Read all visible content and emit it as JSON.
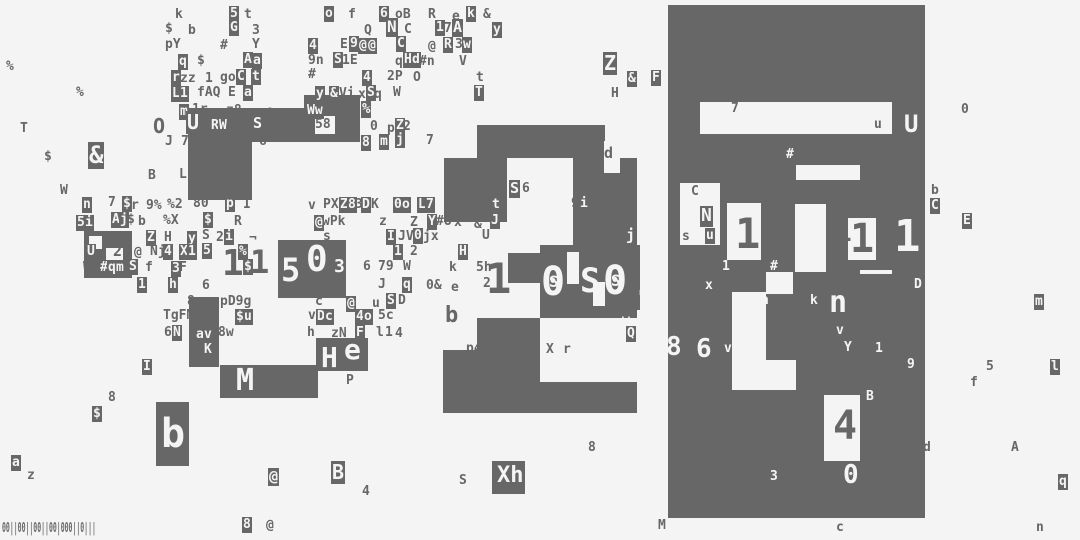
{
  "canvas": {
    "width": 1080,
    "height": 540,
    "bg": "#f4f4f4",
    "ink": "#676767"
  },
  "barcode": {
    "text": "00||00||00||00|000||0|||"
  },
  "blocks": [
    [
      668,
      5,
      257,
      513
    ],
    [
      188,
      108,
      172,
      34
    ],
    [
      304,
      95,
      56,
      14
    ],
    [
      188,
      142,
      64,
      58
    ],
    [
      84,
      231,
      48,
      47
    ],
    [
      278,
      240,
      68,
      58
    ],
    [
      189,
      297,
      30,
      70
    ],
    [
      220,
      365,
      98,
      33
    ],
    [
      316,
      338,
      52,
      33
    ],
    [
      156,
      402,
      33,
      64
    ],
    [
      492,
      461,
      33,
      33
    ],
    [
      477,
      125,
      128,
      33
    ],
    [
      444,
      158,
      63,
      64
    ],
    [
      573,
      158,
      64,
      95
    ],
    [
      508,
      253,
      32,
      30
    ],
    [
      540,
      245,
      100,
      65
    ],
    [
      477,
      318,
      63,
      64
    ],
    [
      540,
      295,
      97,
      23
    ],
    [
      443,
      350,
      64,
      32
    ],
    [
      443,
      382,
      194,
      31
    ]
  ],
  "holes": [
    [
      700,
      102,
      192,
      32
    ],
    [
      796,
      165,
      64,
      15
    ],
    [
      680,
      183,
      40,
      62
    ],
    [
      727,
      203,
      34,
      57
    ],
    [
      795,
      204,
      31,
      68
    ],
    [
      848,
      218,
      28,
      42
    ],
    [
      732,
      292,
      34,
      78
    ],
    [
      766,
      272,
      27,
      22
    ],
    [
      860,
      270,
      32,
      4
    ],
    [
      732,
      360,
      64,
      30
    ],
    [
      824,
      395,
      36,
      66
    ],
    [
      604,
      141,
      16,
      32
    ],
    [
      567,
      252,
      12,
      32
    ],
    [
      593,
      282,
      12,
      24
    ],
    [
      315,
      116,
      20,
      18
    ],
    [
      89,
      236,
      13,
      13
    ],
    [
      106,
      248,
      17,
      13
    ]
  ],
  "glyphs": [
    [
      175,
      8,
      "k",
      0
    ],
    [
      229,
      6,
      "5",
      1
    ],
    [
      244,
      8,
      "t",
      0
    ],
    [
      324,
      6,
      "o",
      1
    ],
    [
      348,
      8,
      "f",
      0
    ],
    [
      379,
      6,
      "6",
      1
    ],
    [
      395,
      8,
      "oB",
      0
    ],
    [
      428,
      8,
      "R",
      0
    ],
    [
      452,
      10,
      "e",
      0
    ],
    [
      466,
      6,
      "k",
      1
    ],
    [
      483,
      8,
      "&",
      0
    ],
    [
      165,
      22,
      "$",
      0
    ],
    [
      188,
      24,
      "b",
      0
    ],
    [
      229,
      20,
      "G",
      1
    ],
    [
      252,
      24,
      "3",
      0
    ],
    [
      364,
      24,
      "Q",
      0
    ],
    [
      386,
      18,
      "N",
      1,
      16
    ],
    [
      404,
      23,
      "C",
      0
    ],
    [
      435,
      20,
      "1",
      1
    ],
    [
      444,
      22,
      "7",
      0
    ],
    [
      452,
      19,
      "A",
      1,
      15
    ],
    [
      492,
      22,
      "y",
      1
    ],
    [
      165,
      38,
      "pY",
      0
    ],
    [
      220,
      39,
      "#",
      0
    ],
    [
      252,
      38,
      "Y",
      0
    ],
    [
      308,
      38,
      "4",
      1
    ],
    [
      340,
      38,
      "E",
      0
    ],
    [
      349,
      36,
      "9",
      1
    ],
    [
      358,
      38,
      "@",
      1
    ],
    [
      367,
      38,
      "@",
      1
    ],
    [
      396,
      36,
      "C",
      1
    ],
    [
      428,
      40,
      "@",
      0
    ],
    [
      443,
      37,
      "R",
      1
    ],
    [
      455,
      38,
      "3",
      0
    ],
    [
      462,
      37,
      "w",
      1
    ],
    [
      178,
      54,
      "q",
      1
    ],
    [
      197,
      54,
      "$",
      0
    ],
    [
      243,
      52,
      "A",
      1
    ],
    [
      252,
      53,
      "a",
      1
    ],
    [
      308,
      54,
      "9n",
      0
    ],
    [
      333,
      52,
      "S",
      1
    ],
    [
      342,
      54,
      "1E",
      0
    ],
    [
      395,
      55,
      "q",
      0
    ],
    [
      403,
      52,
      "H",
      1
    ],
    [
      411,
      52,
      "d",
      1
    ],
    [
      419,
      55,
      "#n",
      0
    ],
    [
      459,
      55,
      "V",
      0
    ],
    [
      603,
      52,
      "Z",
      1,
      20
    ],
    [
      171,
      70,
      "r",
      1
    ],
    [
      180,
      72,
      "zz",
      0
    ],
    [
      205,
      72,
      "1",
      0
    ],
    [
      220,
      71,
      "go",
      0
    ],
    [
      236,
      69,
      "C",
      1
    ],
    [
      251,
      69,
      "t",
      1
    ],
    [
      308,
      68,
      "#",
      0
    ],
    [
      362,
      70,
      "4",
      1
    ],
    [
      387,
      70,
      "2P",
      0
    ],
    [
      413,
      71,
      "O",
      0
    ],
    [
      476,
      71,
      "t",
      0
    ],
    [
      627,
      71,
      "&",
      1
    ],
    [
      651,
      70,
      "F",
      1
    ],
    [
      171,
      86,
      "L",
      1
    ],
    [
      179,
      86,
      "1",
      1
    ],
    [
      197,
      86,
      "fAQ",
      0
    ],
    [
      228,
      86,
      "E",
      0
    ],
    [
      243,
      85,
      "a",
      1
    ],
    [
      315,
      86,
      "y",
      1
    ],
    [
      329,
      86,
      "&",
      1
    ],
    [
      339,
      87,
      "Vi",
      0
    ],
    [
      358,
      88,
      "x",
      0
    ],
    [
      366,
      85,
      "S",
      1
    ],
    [
      374,
      88,
      "q",
      0
    ],
    [
      393,
      86,
      "W",
      0
    ],
    [
      474,
      85,
      "T",
      1
    ],
    [
      611,
      87,
      "H",
      0
    ],
    [
      6,
      60,
      "%",
      0
    ],
    [
      76,
      86,
      "%",
      0
    ],
    [
      20,
      122,
      "T",
      0
    ],
    [
      44,
      150,
      "$",
      0
    ],
    [
      88,
      142,
      "&",
      1,
      24
    ],
    [
      60,
      184,
      "W",
      0
    ],
    [
      179,
      104,
      "m",
      1
    ],
    [
      192,
      103,
      "1r",
      0
    ],
    [
      226,
      104,
      "z8",
      0
    ],
    [
      266,
      105,
      "e",
      0
    ],
    [
      306,
      103,
      "Ww",
      1
    ],
    [
      338,
      105,
      "8",
      0
    ],
    [
      361,
      101,
      "%",
      1,
      14
    ],
    [
      961,
      103,
      "0",
      0
    ],
    [
      153,
      116,
      "O",
      0,
      20
    ],
    [
      186,
      111,
      "U",
      1,
      20
    ],
    [
      210,
      118,
      "R",
      1
    ],
    [
      218,
      118,
      "W",
      1
    ],
    [
      243,
      120,
      "6",
      0
    ],
    [
      252,
      115,
      "S",
      1,
      15
    ],
    [
      315,
      118,
      "58",
      0
    ],
    [
      370,
      120,
      "0",
      0
    ],
    [
      387,
      122,
      "p",
      0
    ],
    [
      395,
      118,
      "Z",
      1
    ],
    [
      403,
      120,
      "2",
      0
    ],
    [
      165,
      135,
      "J",
      0
    ],
    [
      181,
      135,
      "7x",
      0
    ],
    [
      217,
      134,
      "7d",
      0
    ],
    [
      259,
      135,
      "6",
      0
    ],
    [
      361,
      135,
      "8",
      1
    ],
    [
      379,
      134,
      "m",
      1
    ],
    [
      395,
      132,
      "j",
      1
    ],
    [
      426,
      134,
      "7",
      0
    ],
    [
      604,
      146,
      "d",
      0,
      15
    ],
    [
      731,
      102,
      "7",
      0
    ],
    [
      874,
      118,
      "u",
      0
    ],
    [
      904,
      112,
      "U",
      2,
      24
    ],
    [
      786,
      148,
      "#",
      2
    ],
    [
      219,
      144,
      "t",
      0,
      22
    ],
    [
      148,
      169,
      "B",
      0
    ],
    [
      179,
      168,
      "L",
      0
    ],
    [
      82,
      197,
      "n",
      1
    ],
    [
      108,
      196,
      "7",
      0
    ],
    [
      122,
      196,
      "$",
      1
    ],
    [
      131,
      199,
      "r",
      0
    ],
    [
      146,
      199,
      "9%",
      0
    ],
    [
      167,
      198,
      "%2",
      0
    ],
    [
      193,
      197,
      "80",
      0
    ],
    [
      225,
      196,
      "p",
      1
    ],
    [
      243,
      198,
      "I",
      0
    ],
    [
      308,
      199,
      "v",
      0
    ],
    [
      323,
      198,
      "PX",
      0
    ],
    [
      339,
      197,
      "Z",
      1
    ],
    [
      347,
      197,
      "8",
      1
    ],
    [
      355,
      198,
      "3",
      0
    ],
    [
      361,
      197,
      "D",
      1
    ],
    [
      371,
      198,
      "K",
      0
    ],
    [
      393,
      197,
      "0",
      1
    ],
    [
      401,
      197,
      "o",
      1
    ],
    [
      417,
      197,
      "L",
      1
    ],
    [
      425,
      197,
      "7",
      1
    ],
    [
      443,
      199,
      "I",
      0
    ],
    [
      458,
      200,
      "z",
      0
    ],
    [
      691,
      185,
      "C",
      0
    ],
    [
      931,
      184,
      "b",
      0
    ],
    [
      76,
      215,
      "5",
      1
    ],
    [
      84,
      215,
      "i",
      1
    ],
    [
      111,
      212,
      "A",
      1
    ],
    [
      119,
      212,
      "j",
      1
    ],
    [
      127,
      213,
      "$",
      0
    ],
    [
      138,
      215,
      "b",
      0
    ],
    [
      163,
      214,
      "%X",
      0
    ],
    [
      203,
      212,
      "$",
      1
    ],
    [
      234,
      215,
      "R",
      0
    ],
    [
      314,
      215,
      "@",
      1
    ],
    [
      322,
      215,
      "wPk",
      0
    ],
    [
      379,
      215,
      "z",
      0
    ],
    [
      410,
      216,
      "Z",
      0
    ],
    [
      427,
      214,
      "Y",
      1
    ],
    [
      436,
      215,
      "#U",
      0
    ],
    [
      454,
      216,
      "x",
      0
    ],
    [
      474,
      218,
      "&",
      0
    ],
    [
      490,
      213,
      "J",
      1
    ],
    [
      930,
      198,
      "C",
      1
    ],
    [
      682,
      230,
      "s",
      0
    ],
    [
      962,
      213,
      "E",
      1
    ],
    [
      146,
      230,
      "Z",
      1
    ],
    [
      164,
      231,
      "H",
      0
    ],
    [
      187,
      231,
      "y",
      1
    ],
    [
      202,
      229,
      "S",
      0
    ],
    [
      216,
      231,
      "2",
      0
    ],
    [
      224,
      229,
      "i",
      1
    ],
    [
      249,
      232,
      "¬",
      0
    ],
    [
      323,
      230,
      "s",
      0
    ],
    [
      386,
      229,
      "I",
      1
    ],
    [
      398,
      230,
      "JV",
      0
    ],
    [
      413,
      228,
      "0",
      1
    ],
    [
      423,
      230,
      "jx",
      0
    ],
    [
      482,
      229,
      "U",
      0
    ],
    [
      700,
      206,
      "N",
      1,
      18
    ],
    [
      705,
      228,
      "u",
      1
    ],
    [
      86,
      244,
      "U",
      1
    ],
    [
      113,
      244,
      "2",
      0,
      15
    ],
    [
      134,
      246,
      "@",
      0
    ],
    [
      150,
      245,
      "Nj",
      0
    ],
    [
      163,
      244,
      "4",
      1
    ],
    [
      179,
      244,
      "X",
      1
    ],
    [
      187,
      244,
      "1",
      1
    ],
    [
      202,
      243,
      "5",
      1
    ],
    [
      238,
      244,
      "%",
      1
    ],
    [
      393,
      244,
      "1",
      1
    ],
    [
      410,
      245,
      "2",
      0
    ],
    [
      458,
      244,
      "H",
      1
    ],
    [
      83,
      261,
      "W3",
      0
    ],
    [
      99,
      260,
      "#",
      1
    ],
    [
      107,
      260,
      "q",
      1
    ],
    [
      115,
      260,
      "m",
      1
    ],
    [
      128,
      259,
      "S",
      1
    ],
    [
      145,
      261,
      "f",
      0
    ],
    [
      171,
      261,
      "3",
      1
    ],
    [
      179,
      261,
      "F",
      0
    ],
    [
      243,
      259,
      "$",
      1
    ],
    [
      363,
      260,
      "6",
      0
    ],
    [
      378,
      260,
      "79",
      0
    ],
    [
      403,
      260,
      "W",
      0
    ],
    [
      449,
      261,
      "k",
      0
    ],
    [
      476,
      261,
      "5h",
      0
    ],
    [
      137,
      277,
      "1",
      1
    ],
    [
      168,
      277,
      "h",
      1
    ],
    [
      202,
      279,
      "6",
      0
    ],
    [
      378,
      278,
      "J",
      0
    ],
    [
      402,
      277,
      "q",
      1
    ],
    [
      426,
      279,
      "0&",
      0
    ],
    [
      451,
      281,
      "e",
      0
    ],
    [
      483,
      277,
      "2",
      0
    ],
    [
      187,
      295,
      "8",
      0
    ],
    [
      220,
      295,
      "pD9g",
      0
    ],
    [
      315,
      295,
      "c",
      0
    ],
    [
      346,
      296,
      "@",
      1
    ],
    [
      372,
      297,
      "u",
      0
    ],
    [
      386,
      293,
      "S",
      1
    ],
    [
      398,
      294,
      "D",
      0
    ],
    [
      163,
      309,
      "TgFM",
      0
    ],
    [
      235,
      309,
      "$",
      1
    ],
    [
      243,
      309,
      "u",
      1
    ],
    [
      308,
      309,
      "v",
      0
    ],
    [
      316,
      309,
      "D",
      1
    ],
    [
      324,
      309,
      "c",
      1
    ],
    [
      355,
      309,
      "4",
      1
    ],
    [
      363,
      309,
      "o",
      1
    ],
    [
      378,
      309,
      "5c",
      0
    ],
    [
      445,
      305,
      "b",
      0,
      22
    ],
    [
      164,
      326,
      "6",
      0
    ],
    [
      172,
      325,
      "N",
      1
    ],
    [
      195,
      327,
      "a",
      1
    ],
    [
      203,
      327,
      "v",
      1
    ],
    [
      218,
      326,
      "8w",
      0
    ],
    [
      307,
      326,
      "h",
      0
    ],
    [
      331,
      327,
      "zN",
      0
    ],
    [
      355,
      325,
      "F",
      1
    ],
    [
      376,
      326,
      "l",
      0
    ],
    [
      385,
      326,
      "1",
      0
    ],
    [
      395,
      327,
      "4",
      0
    ],
    [
      203,
      342,
      "K",
      1
    ],
    [
      466,
      342,
      "p4",
      0
    ],
    [
      546,
      343,
      "X",
      0
    ],
    [
      563,
      343,
      "r",
      0
    ],
    [
      509,
      180,
      "S",
      1,
      15
    ],
    [
      522,
      182,
      "6",
      0
    ],
    [
      571,
      197,
      "9",
      0
    ],
    [
      579,
      196,
      "i",
      1
    ],
    [
      483,
      199,
      "#",
      0
    ],
    [
      491,
      197,
      "t",
      1
    ],
    [
      626,
      228,
      "j",
      2,
      15
    ],
    [
      622,
      314,
      "w",
      2
    ],
    [
      626,
      326,
      "Q",
      1
    ],
    [
      705,
      279,
      "x",
      2
    ],
    [
      722,
      260,
      "1",
      2
    ],
    [
      770,
      260,
      "#",
      2
    ],
    [
      761,
      294,
      "h",
      2
    ],
    [
      810,
      294,
      "k",
      2
    ],
    [
      829,
      288,
      "n",
      2,
      30
    ],
    [
      836,
      324,
      "v",
      2
    ],
    [
      843,
      340,
      "Y",
      1
    ],
    [
      875,
      342,
      "1",
      2
    ],
    [
      906,
      357,
      "9",
      1
    ],
    [
      914,
      278,
      "D",
      2
    ],
    [
      666,
      334,
      "8",
      2,
      26
    ],
    [
      696,
      336,
      "6",
      2,
      26
    ],
    [
      724,
      342,
      "v",
      2
    ],
    [
      866,
      390,
      "B",
      2
    ],
    [
      770,
      470,
      "3",
      2
    ],
    [
      843,
      462,
      "0",
      2,
      26
    ],
    [
      833,
      406,
      "4",
      0,
      40
    ],
    [
      986,
      360,
      "5",
      0
    ],
    [
      970,
      376,
      "f",
      0
    ],
    [
      1050,
      359,
      "l",
      1
    ],
    [
      923,
      441,
      "d",
      0
    ],
    [
      1011,
      441,
      "A",
      0
    ],
    [
      1058,
      474,
      "q",
      1
    ],
    [
      1034,
      294,
      "m",
      1
    ],
    [
      142,
      359,
      "I",
      1
    ],
    [
      108,
      391,
      "8",
      0
    ],
    [
      92,
      406,
      "$",
      1
    ],
    [
      161,
      414,
      "b",
      2,
      40
    ],
    [
      11,
      455,
      "a",
      1
    ],
    [
      27,
      469,
      "z",
      0
    ],
    [
      268,
      468,
      "@",
      1,
      15
    ],
    [
      331,
      461,
      "B",
      1,
      20
    ],
    [
      362,
      485,
      "4",
      0
    ],
    [
      459,
      474,
      "S",
      0
    ],
    [
      497,
      465,
      "Xh",
      2,
      22
    ],
    [
      588,
      441,
      "8",
      0
    ],
    [
      236,
      366,
      "M",
      2,
      30
    ],
    [
      346,
      374,
      "P",
      0
    ],
    [
      321,
      344,
      "H",
      2,
      28
    ],
    [
      344,
      336,
      "e",
      2,
      28
    ],
    [
      242,
      517,
      "8",
      1
    ],
    [
      266,
      519,
      "@",
      0
    ],
    [
      658,
      519,
      "M",
      0
    ],
    [
      836,
      521,
      "c",
      0
    ],
    [
      1036,
      521,
      "n",
      0
    ],
    [
      222,
      246,
      "1",
      0,
      36
    ],
    [
      250,
      246,
      "1",
      0,
      32
    ],
    [
      281,
      254,
      "5",
      2,
      32
    ],
    [
      306,
      242,
      "0",
      2,
      36
    ],
    [
      334,
      258,
      "3",
      2,
      18
    ],
    [
      314,
      278,
      "94",
      0
    ],
    [
      486,
      258,
      "1",
      0,
      42
    ],
    [
      541,
      262,
      "0",
      2,
      40
    ],
    [
      549,
      274,
      "S",
      2,
      16
    ],
    [
      580,
      264,
      "S",
      2,
      34
    ],
    [
      603,
      261,
      "0",
      2,
      40
    ],
    [
      611,
      273,
      "S",
      2,
      16
    ],
    [
      636,
      262,
      "1",
      2,
      40
    ],
    [
      648,
      266,
      "S",
      2,
      32
    ],
    [
      735,
      213,
      "1",
      0,
      42
    ],
    [
      764,
      217,
      "1",
      0,
      40
    ],
    [
      798,
      213,
      "0",
      2,
      44
    ],
    [
      806,
      226,
      "S",
      2,
      18
    ],
    [
      836,
      220,
      "1",
      0,
      26
    ],
    [
      850,
      219,
      "1",
      0,
      40
    ],
    [
      894,
      215,
      "1",
      2,
      44
    ]
  ]
}
